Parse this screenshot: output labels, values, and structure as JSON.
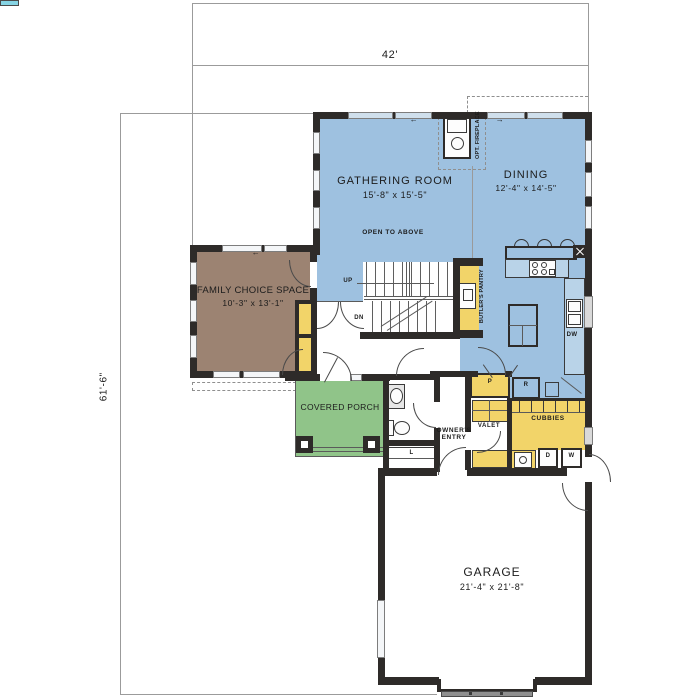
{
  "dimensions": {
    "overall_width": "42'",
    "overall_depth": "61'-6\""
  },
  "rooms": {
    "gathering_room": {
      "name": "GATHERING ROOM",
      "size": "15'-8\" x 15'-5\"",
      "note": "OPEN TO ABOVE"
    },
    "dining": {
      "name": "DINING",
      "size": "12'-4\" x 14'-5\""
    },
    "family_choice_space": {
      "name": "FAMILY CHOICE SPACE",
      "size": "10'-3\" x 13'-1\""
    },
    "covered_porch": {
      "name": "COVERED PORCH"
    },
    "owners_entry": {
      "name": "OWNER'S ENTRY"
    },
    "garage": {
      "name": "GARAGE",
      "size": "21'-4\" x 21'-8\""
    },
    "butlers_pantry": {
      "name": "BUTLER'S PANTRY"
    },
    "valet": {
      "name": "VALET"
    },
    "cubbies": {
      "name": "CUBBIES"
    }
  },
  "labels": {
    "up": "UP",
    "down": "DN",
    "optional_fireplace": "OPT. FIREPLACE",
    "dishwasher": "DW",
    "pantry": "P",
    "refrigerator": "R",
    "linen_closet": "L",
    "dryer": "D",
    "washer": "W",
    "window_arrow_left": "←",
    "window_arrow_right": "→"
  },
  "colors": {
    "living_area_blue": "#9ec1e0",
    "family_choice_brown": "#9c8372",
    "porch_green": "#90c489",
    "storage_yellow": "#f2d469",
    "wall_black": "#2e2b29",
    "lot_line_gray": "#9b9b9b"
  }
}
